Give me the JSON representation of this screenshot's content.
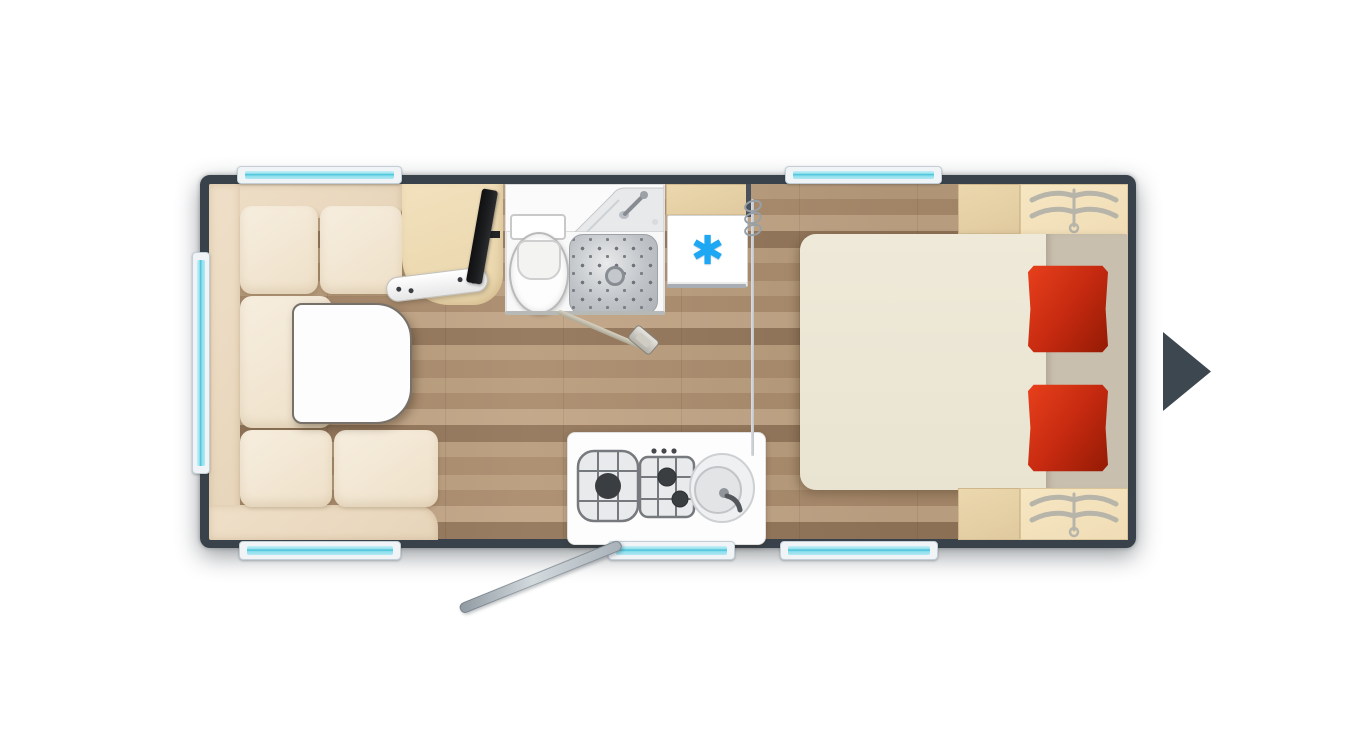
{
  "view": "caravan-top-down-floor-plan",
  "icons": {
    "snowflake": "✱",
    "hanger": "clothes-hanger-glyph",
    "next_arrow": "right-pointing-triangle"
  },
  "colors": {
    "wall": "#39424a",
    "wood-a": "#b99c7c",
    "wood-b": "#aa8b6c",
    "wood-c": "#c1a485",
    "wood-d": "#93765a",
    "sofa-back": "#e7d5ba",
    "sofa-seat": "#f7eedf",
    "table": "#fdfdfd",
    "sideboard": "#e9d5ab",
    "cabinet": "#e0c99f",
    "wardrobe": "#f0ddb6",
    "bed": "#e9e3d1",
    "bed-head": "#c9bfae",
    "pillow": "#c62a10",
    "pillow-dark": "#921a04",
    "glass": "#8fdfee",
    "glass-line": "#46c1d6",
    "frame": "#f0f4f7",
    "accent": "#1ea7f2",
    "bath": "#f8f8f9",
    "shower": "#c0c4c8",
    "fridge": "#ffffff",
    "tv": "#1d1e20",
    "arrow": "#3d4750"
  },
  "inventory": {
    "rooms": [
      "lounge",
      "washroom",
      "kitchen",
      "bedroom"
    ],
    "furniture": {
      "lounge": [
        "l-shaped-sofa",
        "table",
        "tv",
        "sideboard",
        "wall-shelf"
      ],
      "washroom": [
        "washbasin",
        "toilet",
        "shower-tray",
        "washroom-door"
      ],
      "kitchen": [
        "three-burner-hob",
        "kitchen-sink",
        "fridge"
      ],
      "bedroom": [
        "double-bed",
        "pillow-left",
        "pillow-right",
        "wardrobe-top",
        "wardrobe-bottom",
        "privacy-curtain"
      ]
    },
    "openings": {
      "windows": 6,
      "entry_door": 1
    }
  }
}
